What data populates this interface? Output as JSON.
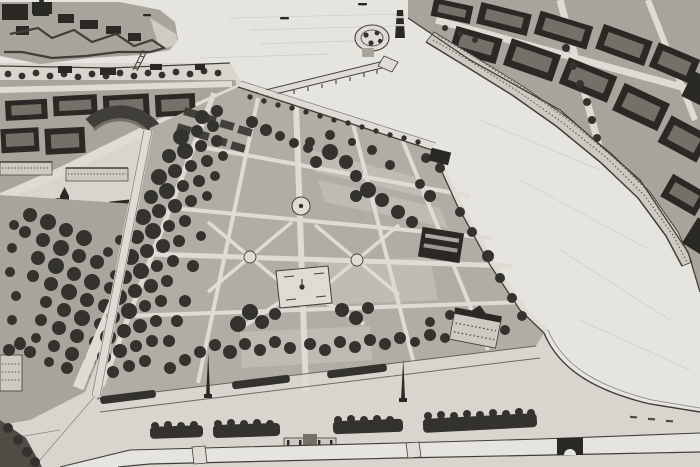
{
  "canvas": {
    "width": 700,
    "height": 467
  },
  "colors": {
    "water": "#eae8e2",
    "land": "#dcd8d1",
    "road": "#e2dfd8",
    "garden": "#b1aea5",
    "ground2": "#a8a59c",
    "panel": "#c3c0b8",
    "tree": "#2e2c28",
    "tree2": "#4b4841",
    "building": "#24221e",
    "court": "#716e66",
    "facade": "#d0ccc4",
    "ink": "#3b3935"
  }
}
